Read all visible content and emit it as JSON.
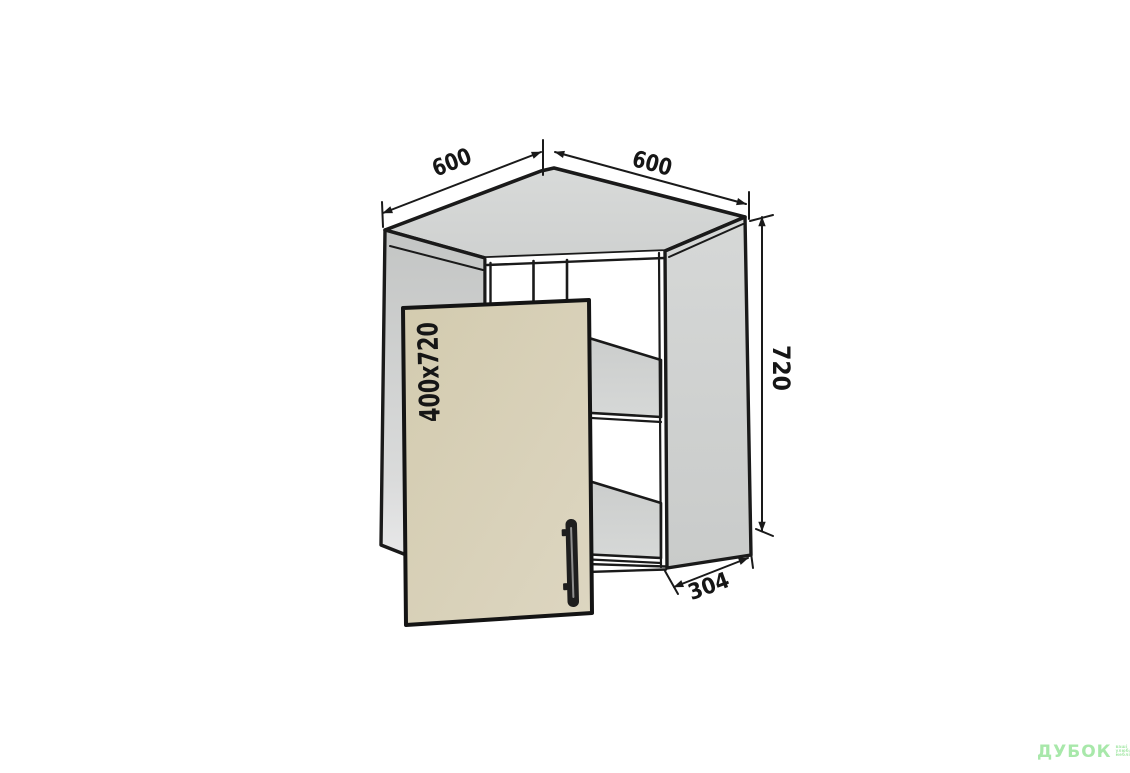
{
  "drawing": {
    "name": "corner-wall-cabinet-technical-drawing",
    "dimensions": {
      "top_left_width": "600",
      "top_right_width": "600",
      "height": "720",
      "side_depth": "304"
    },
    "door": {
      "size_label": "400x720"
    },
    "shelf_count": 2,
    "colors": {
      "outline": "#1a1a1a",
      "panel_gray": "#d2d4d3",
      "door_beige": "#d6ceb3"
    }
  },
  "watermark": {
    "brand": "ДУБОК",
    "color": "#a8e8aa",
    "tagline": [
      "ваші",
      "улюблені",
      "меблі"
    ]
  }
}
